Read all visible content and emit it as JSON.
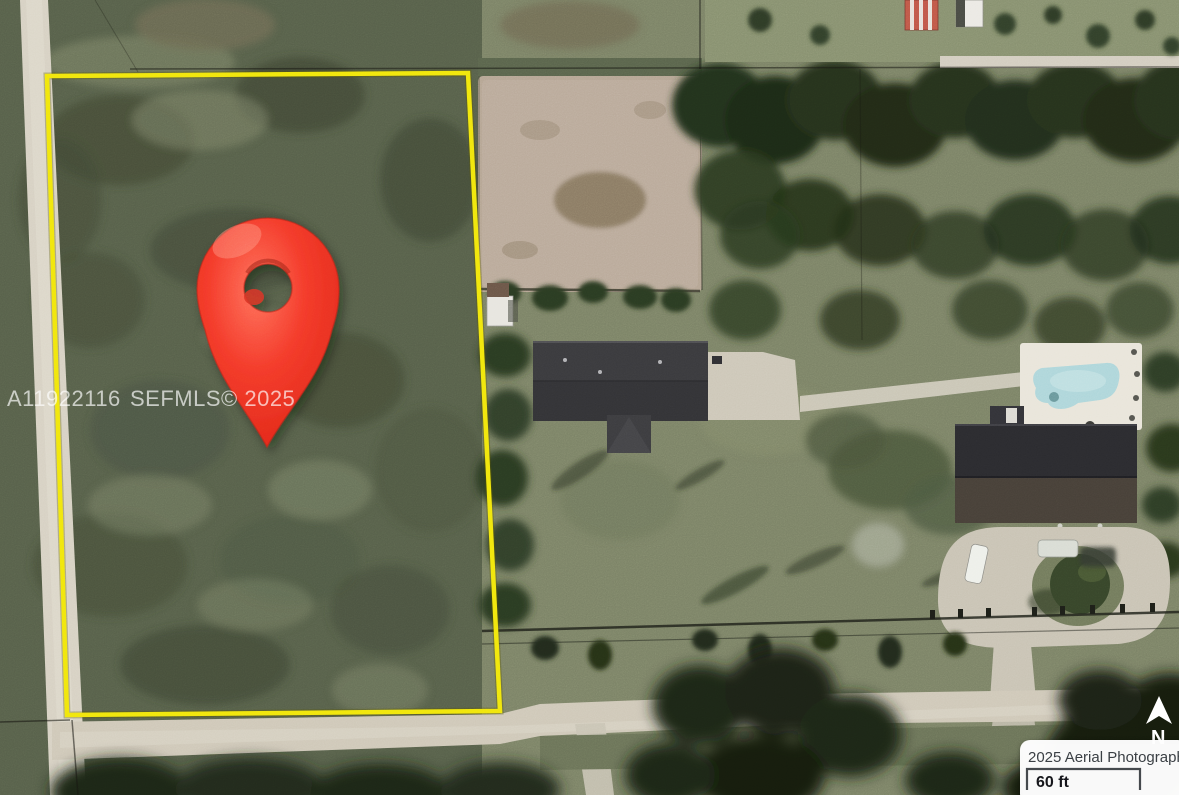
{
  "watermark": {
    "mls_number": "A11922116",
    "attribution": "SEFMLS© 2025"
  },
  "map_overlay": {
    "photo_attribution": "2025 Aerial Photography",
    "scale_bar": {
      "label": "60 ft"
    },
    "north_arrow": {
      "label": "N"
    }
  },
  "marker": {
    "type": "location-pin",
    "color": "#ee3124"
  },
  "parcel": {
    "outline_color": "#f1e60d"
  },
  "colors": {
    "pool_water": "#aed6da",
    "pool_deck": "#e9e5da",
    "roof_dark": "#38383c",
    "roof_brown": "#4a4138",
    "road_light": "#d6d0c2",
    "paddock_dirt": "#b5a593",
    "lawn_green": "#7b8266",
    "vegetation_dark": "#57604a",
    "tree_canopy": "#243019"
  }
}
